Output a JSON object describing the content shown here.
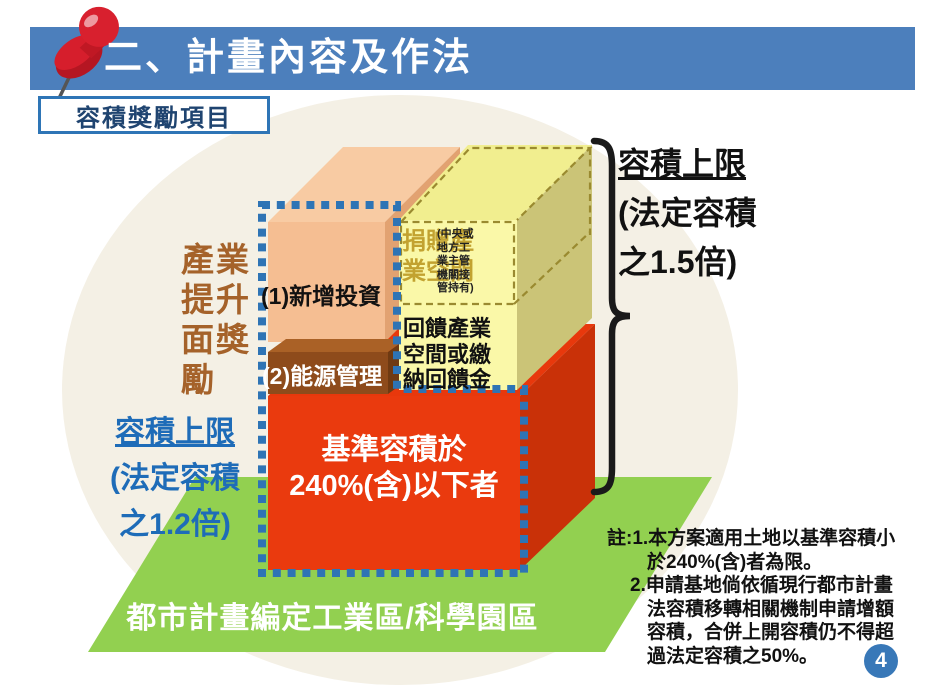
{
  "slide": {
    "title": "二、計畫內容及作法",
    "page_number": "4"
  },
  "badge": {
    "label": "容積獎勵項目"
  },
  "diagram": {
    "award_label": "產業\n提升\n面獎\n勵",
    "left_limit": {
      "title": "容積上限",
      "line2": "(法定容積",
      "line3": "之1.2倍)"
    },
    "right_limit": {
      "title": "容積上限",
      "line2": "(法定容積",
      "line3": "之1.5倍)"
    },
    "invest_label": "(1)新增投資",
    "energy_label": "(2)能源管理",
    "donate_label": "捐贈產\n業空間",
    "donate_note": "(中央或\n地方工\n業主管\n機關接\n管持有)",
    "feedback_label": "回饋產業\n空間或繳\n納回饋金",
    "base_label": "基準容積於\n240%(含)以下者",
    "ground_label": "都市計畫編定工業區/科學園區",
    "colors": {
      "bg_blob": "#F4F0E5",
      "header_bar": "#4C7FBC",
      "badge_border": "#2E75B6",
      "badge_text": "#1F4470",
      "ground_green": "#92D050",
      "red_front": "#EA3A0E",
      "red_top": "#E8380C",
      "red_side": "#C93108",
      "orange_front": "#F5BE92",
      "orange_top": "#F8CBA3",
      "orange_side": "#E2A271",
      "brown_front": "#8E4B1B",
      "brown_top": "#AA6126",
      "brown_side": "#6F3A12",
      "yellow_front": "#FAF8A8",
      "yellow_top": "#F1EE8F",
      "yellow_side": "#CBC477",
      "dashed_olive": "#9A8A30",
      "dotted_blue": "#2E74B5",
      "donate_gold": "#C2A230",
      "left_limit_blue": "#1E6CB8",
      "award_brown": "#A5622A",
      "page_badge_blue": "#3878B8"
    }
  },
  "note": {
    "lines": [
      "註:1.本方案適用土地以基準容積小",
      "於240%(含)者為限。",
      "2.申請基地倘依循現行都市計畫",
      "法容積移轉相關機制申請增額",
      "容積，合併上開容積仍不得超",
      "過法定容積之50%。"
    ]
  }
}
